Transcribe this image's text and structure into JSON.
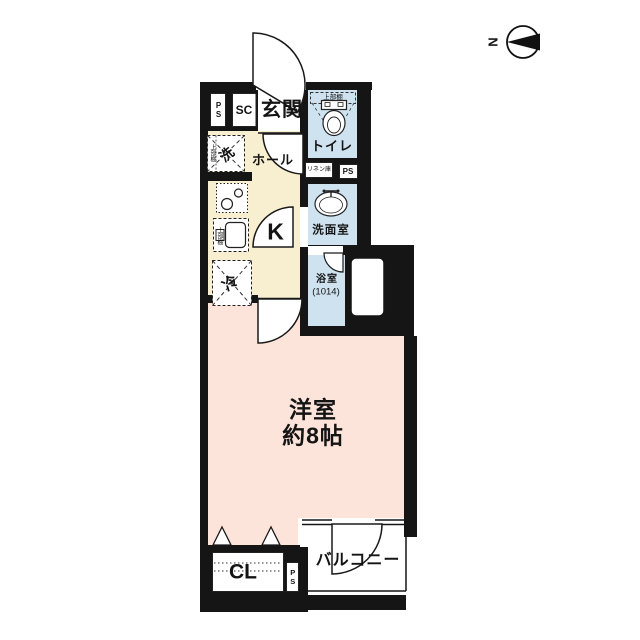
{
  "compass": {
    "north": "N"
  },
  "rooms": {
    "genkan": "玄関",
    "hall": "ホール",
    "kitchen": "K",
    "toilet": "トイレ",
    "washroom": "洗面室",
    "bathroom": "浴室",
    "bathroom_size": "(1014)",
    "western_room": "洋室",
    "western_room_size": "約8帖",
    "balcony": "バルコニー",
    "closet": "CL"
  },
  "fixtures": {
    "washer": "洗",
    "fridge": "冷",
    "shoe_closet": "SC",
    "pipe_space_1": "PS",
    "pipe_space_2": "PS",
    "pipe_space_3": "PS",
    "linen_closet": "リネン庫",
    "shelf_toilet": "上部棚",
    "shelf_washer": "上部棚",
    "shelf_kitchen": "上部棚"
  },
  "colors": {
    "wall": "#151515",
    "hall_floor": "#f8eed0",
    "room_floor": "#fce4da",
    "wet_floor": "#cfe2f0",
    "background": "#ffffff"
  }
}
